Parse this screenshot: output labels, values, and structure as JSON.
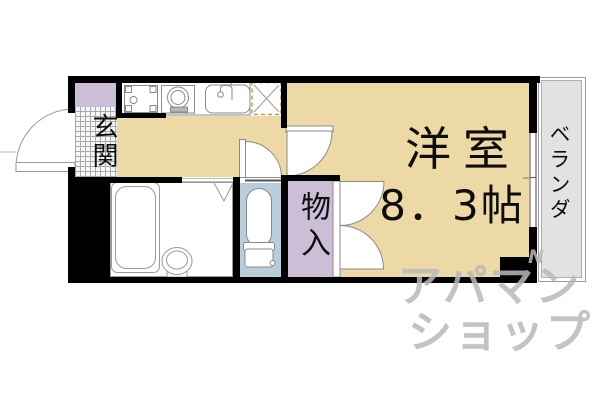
{
  "plan": {
    "type": "apartment-floor-plan",
    "rooms": {
      "entrance": {
        "label": "玄関"
      },
      "western_room": {
        "label": "洋室",
        "size": "8．3帖"
      },
      "storage": {
        "label": "物入"
      },
      "veranda": {
        "label": "ベランダ"
      },
      "kitchen": {
        "fixtures": [
          "washing-machine-pan",
          "stove-burner",
          "kitchen-sink",
          "refrigerator-space"
        ]
      },
      "bathroom": {
        "fixtures": [
          "bathtub",
          "washbasin"
        ]
      },
      "toilet_room": {
        "fixtures": [
          "toilet"
        ]
      }
    },
    "watermark": {
      "line1": "アパマン",
      "line2": "ショップ",
      "mark": "N"
    },
    "colors": {
      "floor": "#ecd9a6",
      "storage_purple": "#ccbed6",
      "toilet_blue": "#b8cedd",
      "veranda_gray": "#e2e2e2",
      "wall": "#000000",
      "fixture_line": "#8a8a8a",
      "fridge_dash": "#c89a5a",
      "watermark_gray": "#b9b9b9"
    }
  }
}
